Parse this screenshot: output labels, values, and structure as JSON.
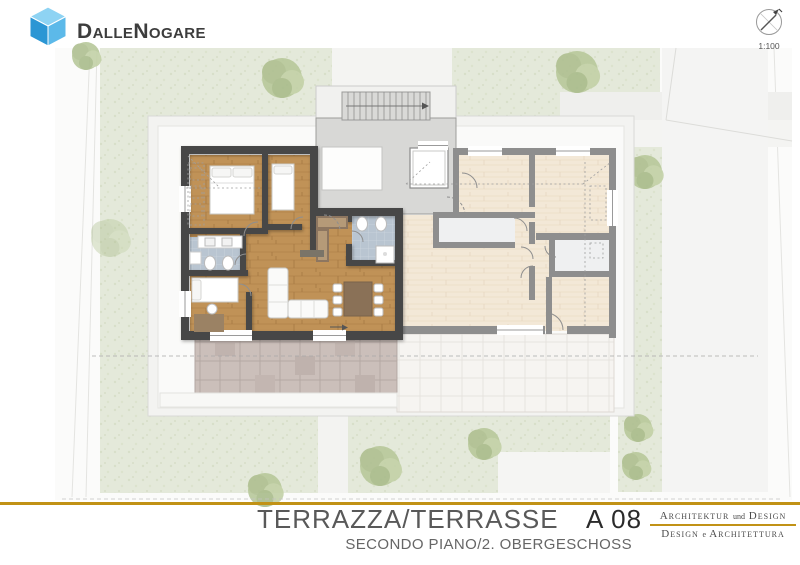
{
  "header": {
    "brand": "DalleNogare",
    "scale_label": "1:100"
  },
  "footer": {
    "title": "TERRAZZA/TERRASSE",
    "sheet_code": "A 08",
    "subtitle": "SECONDO PIANO/2. OBERGESCHOSS",
    "studio_line1_a": "Architektur",
    "studio_line1_joiner": "und",
    "studio_line1_b": "Design",
    "studio_line2_a": "Design",
    "studio_line2_joiner": "e",
    "studio_line2_b": "Architettura"
  },
  "colors": {
    "accent_gold": "#C19216",
    "highlight_wood": "#C09257",
    "wall_dark": "#474747",
    "wall_gray": "#8E8E8E",
    "grass_green": "#E4E9DA",
    "bath_tile_blue": "#B9C5D1",
    "terrace_tile": "#CBBFBA",
    "stairwell_gray": "#D8D8D6",
    "title_gray": "#595959",
    "sheet_code_dark": "#2B2B2B"
  }
}
